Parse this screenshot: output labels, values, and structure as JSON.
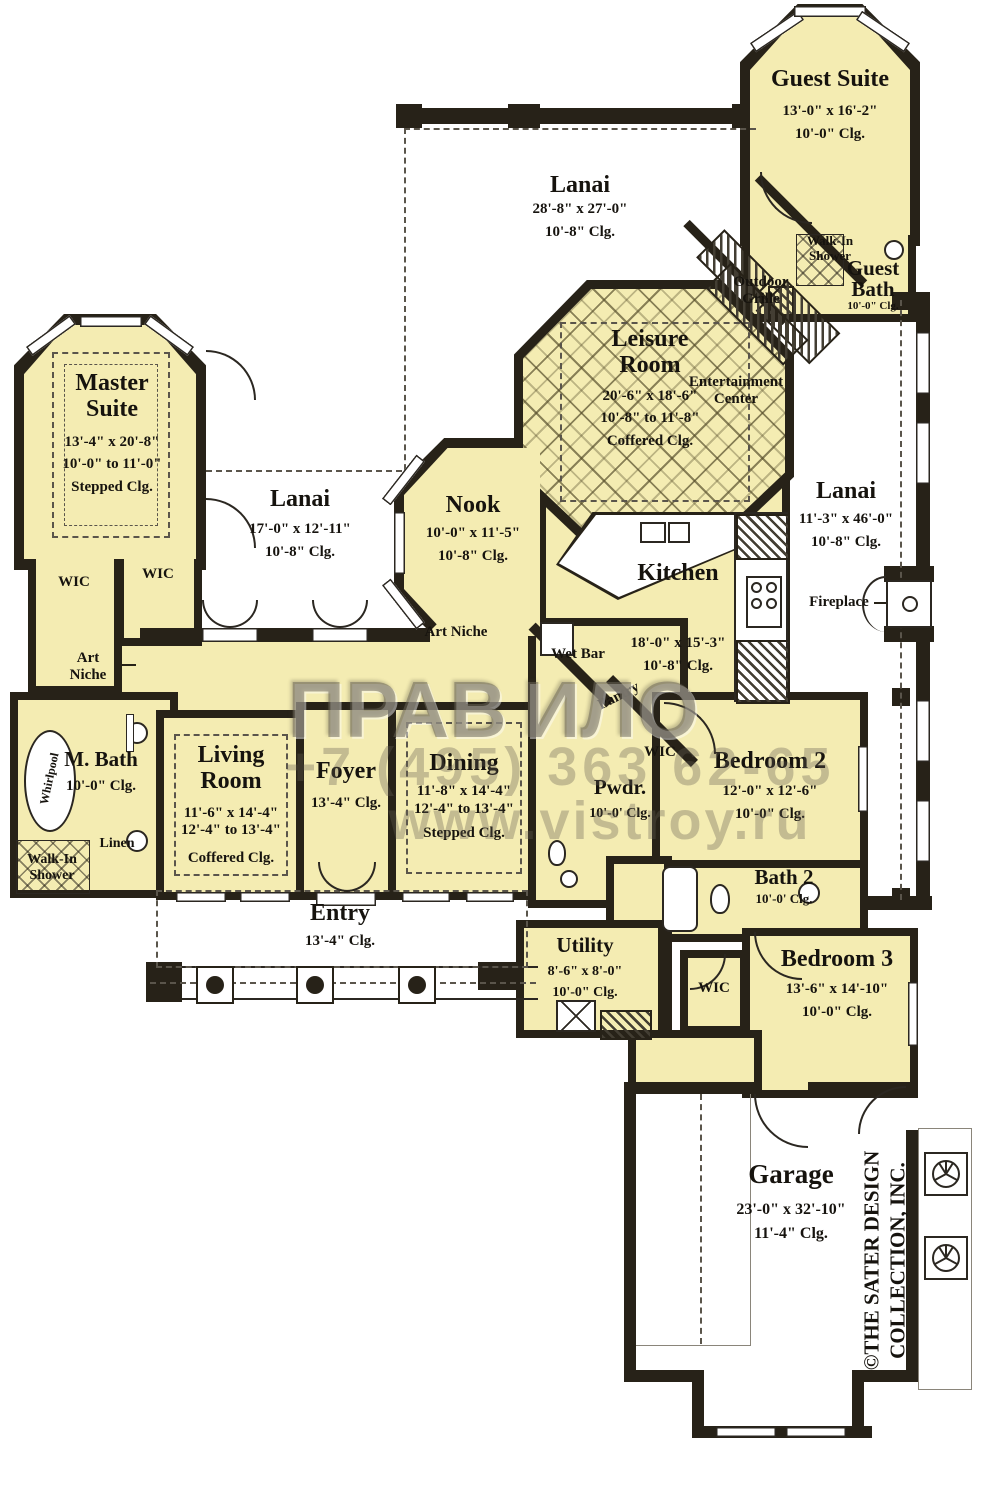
{
  "palette": {
    "room_fill": "#f4ecb2",
    "wall": "#272218",
    "paper": "#ffffff"
  },
  "rooms": {
    "guest_suite": {
      "name": "Guest Suite",
      "dims": "13'-0\" x 16'-2\"",
      "clg": "10'-0\" Clg."
    },
    "guest_bath": {
      "name": "Guest Bath",
      "clg": "10'-0\" Clg."
    },
    "lanai_top": {
      "name": "Lanai",
      "dims": "28'-8\" x 27'-0\"",
      "clg": "10'-8\" Clg."
    },
    "leisure": {
      "name": "Leisure Room",
      "dims": "20'-6\" x 18'-6\"",
      "clg1": "10'-8\" to 11'-8\"",
      "clg2": "Coffered Clg."
    },
    "master": {
      "name": "Master Suite",
      "dims": "13'-4\" x 20'-8\"",
      "clg1": "10'-0\" to 11'-0\"",
      "clg2": "Stepped Clg."
    },
    "lanai_left": {
      "name": "Lanai",
      "dims": "17'-0\" x 12'-11\"",
      "clg": "10'-8\" Clg."
    },
    "lanai_right": {
      "name": "Lanai",
      "dims": "11'-3\" x 46'-0\"",
      "clg": "10'-8\" Clg."
    },
    "nook": {
      "name": "Nook",
      "dims": "10'-0\" x 11'-5\"",
      "clg": "10'-8\" Clg."
    },
    "kitchen": {
      "name": "Kitchen",
      "dims": "18'-0\" x 15'-3\"",
      "clg": "10'-8\" Clg."
    },
    "living": {
      "name": "Living Room",
      "dims": "11'-6\" x 14'-4\"",
      "clg1": "12'-4\" to 13'-4\"",
      "clg2": "Coffered Clg."
    },
    "foyer": {
      "name": "Foyer",
      "clg": "13'-4\" Clg."
    },
    "dining": {
      "name": "Dining",
      "dims": "11'-8\" x 14'-4\"",
      "clg1": "12'-4\" to 13'-4\"",
      "clg2": "Stepped Clg."
    },
    "mbath": {
      "name": "M. Bath",
      "clg": "10'-0\" Clg."
    },
    "pwdr": {
      "name": "Pwdr.",
      "clg": "10'-0' Clg."
    },
    "bedroom2": {
      "name": "Bedroom 2",
      "dims": "12'-0\" x 12'-6\"",
      "clg": "10'-0\" Clg."
    },
    "bath2": {
      "name": "Bath 2",
      "clg": "10'-0' Clg."
    },
    "bedroom3": {
      "name": "Bedroom 3",
      "dims": "13'-6\" x 14'-10\"",
      "clg": "10'-0\" Clg."
    },
    "utility": {
      "name": "Utility",
      "dims": "8'-6\" x 8'-0\"",
      "clg": "10'-0\" Clg."
    },
    "entry": {
      "name": "Entry",
      "clg": "13'-4\" Clg."
    },
    "garage": {
      "name": "Garage",
      "dims": "23'-0\" x 32'-10\"",
      "clg": "11'-4\" Clg."
    }
  },
  "labels": {
    "walk_in_shower": "Walk-In Shower",
    "outdoor_grille": "Outdoor Grille",
    "entertainment_center": "Entertainment Center",
    "fireplace": "Fireplace",
    "wic": "WIC",
    "art_niche": "Art Niche",
    "wet_bar": "Wet Bar",
    "pantry": "Pantry",
    "whirlpool": "Whirlpool",
    "linen": "Linen"
  },
  "copyright": {
    "line1": "©THE SATER DESIGN",
    "line2": "COLLECTION, INC."
  },
  "watermark": {
    "logo_left": "ПРАВ",
    "logo_right": "ИЛО",
    "phone": "+7 (495) 363 62-65",
    "site": "www.vistroy.ru"
  }
}
